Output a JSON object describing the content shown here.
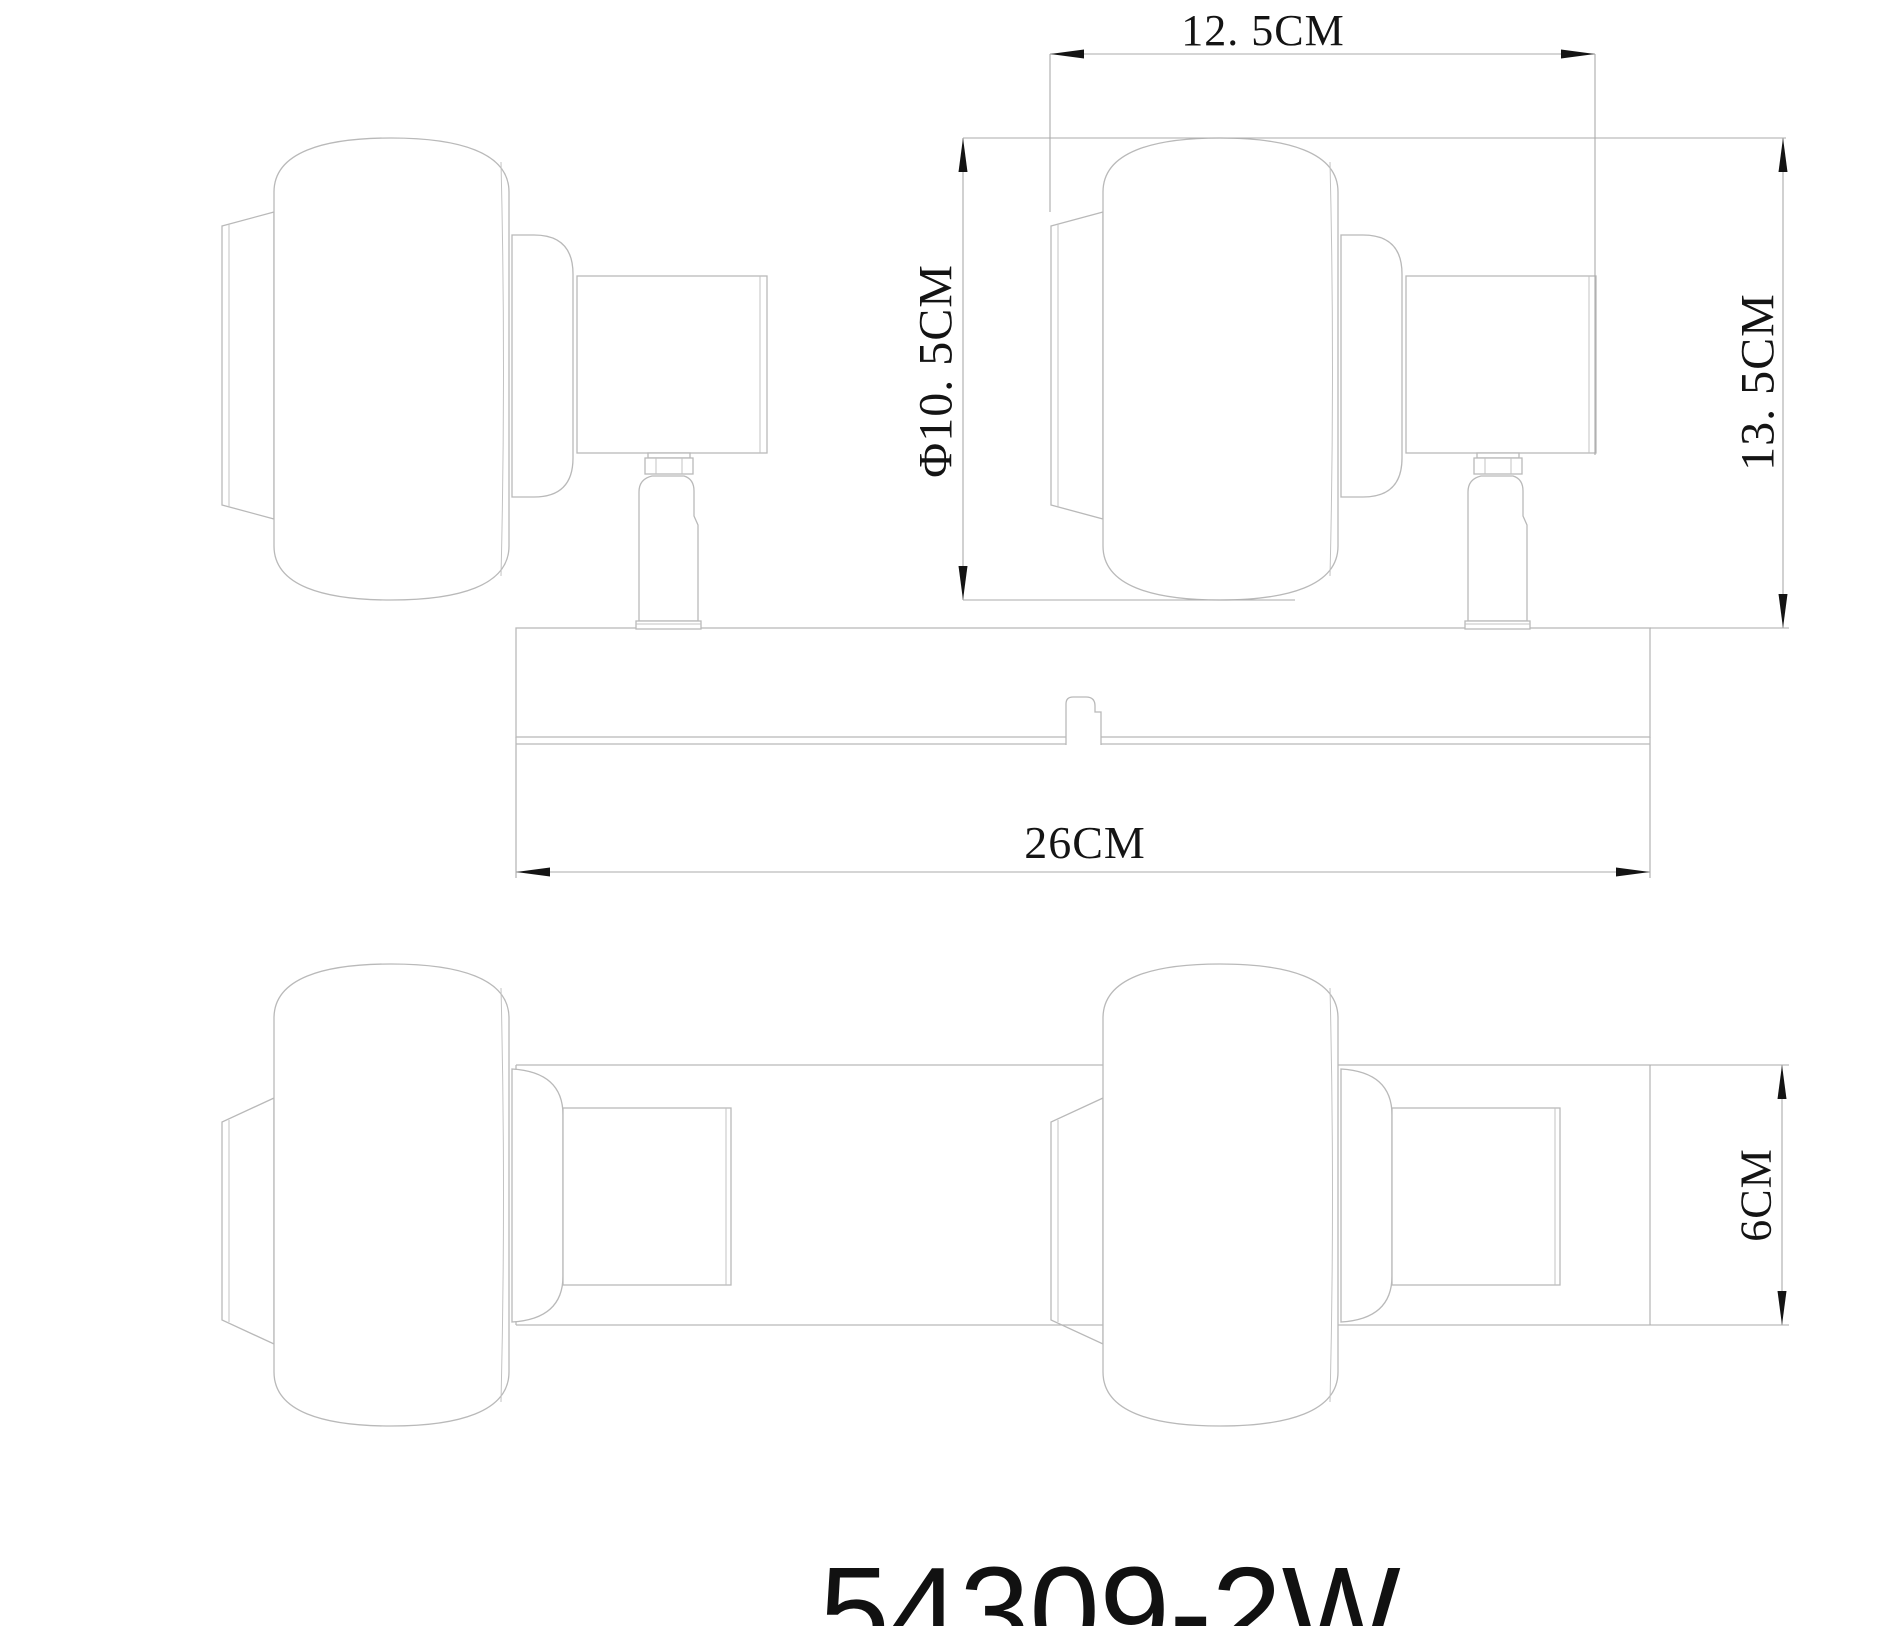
{
  "drawing": {
    "product_code": "54309-2W",
    "type": "2-lamp spotlight mounting-bar fixture, 2-view dimensioned technical drawing",
    "dimensions": {
      "head_depth": {
        "label": "12. 5CM",
        "value_cm": 12.5,
        "orientation": "horizontal",
        "view": "top"
      },
      "shade_diameter": {
        "label": "Φ10. 5CM",
        "value_cm": 10.5,
        "orientation": "vertical",
        "view": "top"
      },
      "fixture_height": {
        "label": "13. 5CM",
        "value_cm": 13.5,
        "orientation": "vertical",
        "view": "top"
      },
      "bar_length": {
        "label": "26CM",
        "value_cm": 26,
        "orientation": "horizontal",
        "view": "top"
      },
      "bar_height": {
        "label": "6CM",
        "value_cm": 6,
        "orientation": "vertical",
        "view": "front"
      }
    },
    "colors": {
      "background": "#ffffff",
      "drawing_lines": "#b9b9b9",
      "dimension_lines": "#ababab",
      "annotation": "#141414"
    }
  }
}
